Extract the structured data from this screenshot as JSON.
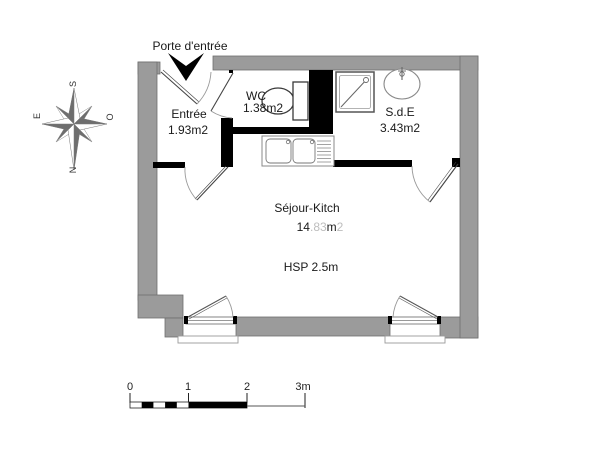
{
  "plan": {
    "entrance_label": "Porte d'entrée",
    "rooms": {
      "entree": {
        "name": "Entrée",
        "area": "1.93m2"
      },
      "wc": {
        "name": "WC",
        "area": "1.38m2"
      },
      "sde": {
        "name": "S.d.E",
        "area": "3.43m2"
      },
      "sejour": {
        "name": "Séjour-Kitch",
        "area_dark_1": "14",
        "area_light_1": ".83",
        "area_dark_2": "m",
        "area_light_2": "2",
        "height_note": "HSP 2.5m"
      }
    }
  },
  "compass": {
    "top": "S",
    "left": "E",
    "right": "O",
    "bottom": "N"
  },
  "scale_bar": {
    "tick_0": "0",
    "tick_1": "1",
    "tick_2": "2",
    "tick_3": "3m"
  },
  "colors": {
    "wall": "#9b9b9b",
    "wall_outline": "#6f6f6f",
    "partition": "#000000",
    "text": "#1a1a1a",
    "faded_text": "#bdbdbd",
    "line": "#444444",
    "arc": "#999999"
  }
}
